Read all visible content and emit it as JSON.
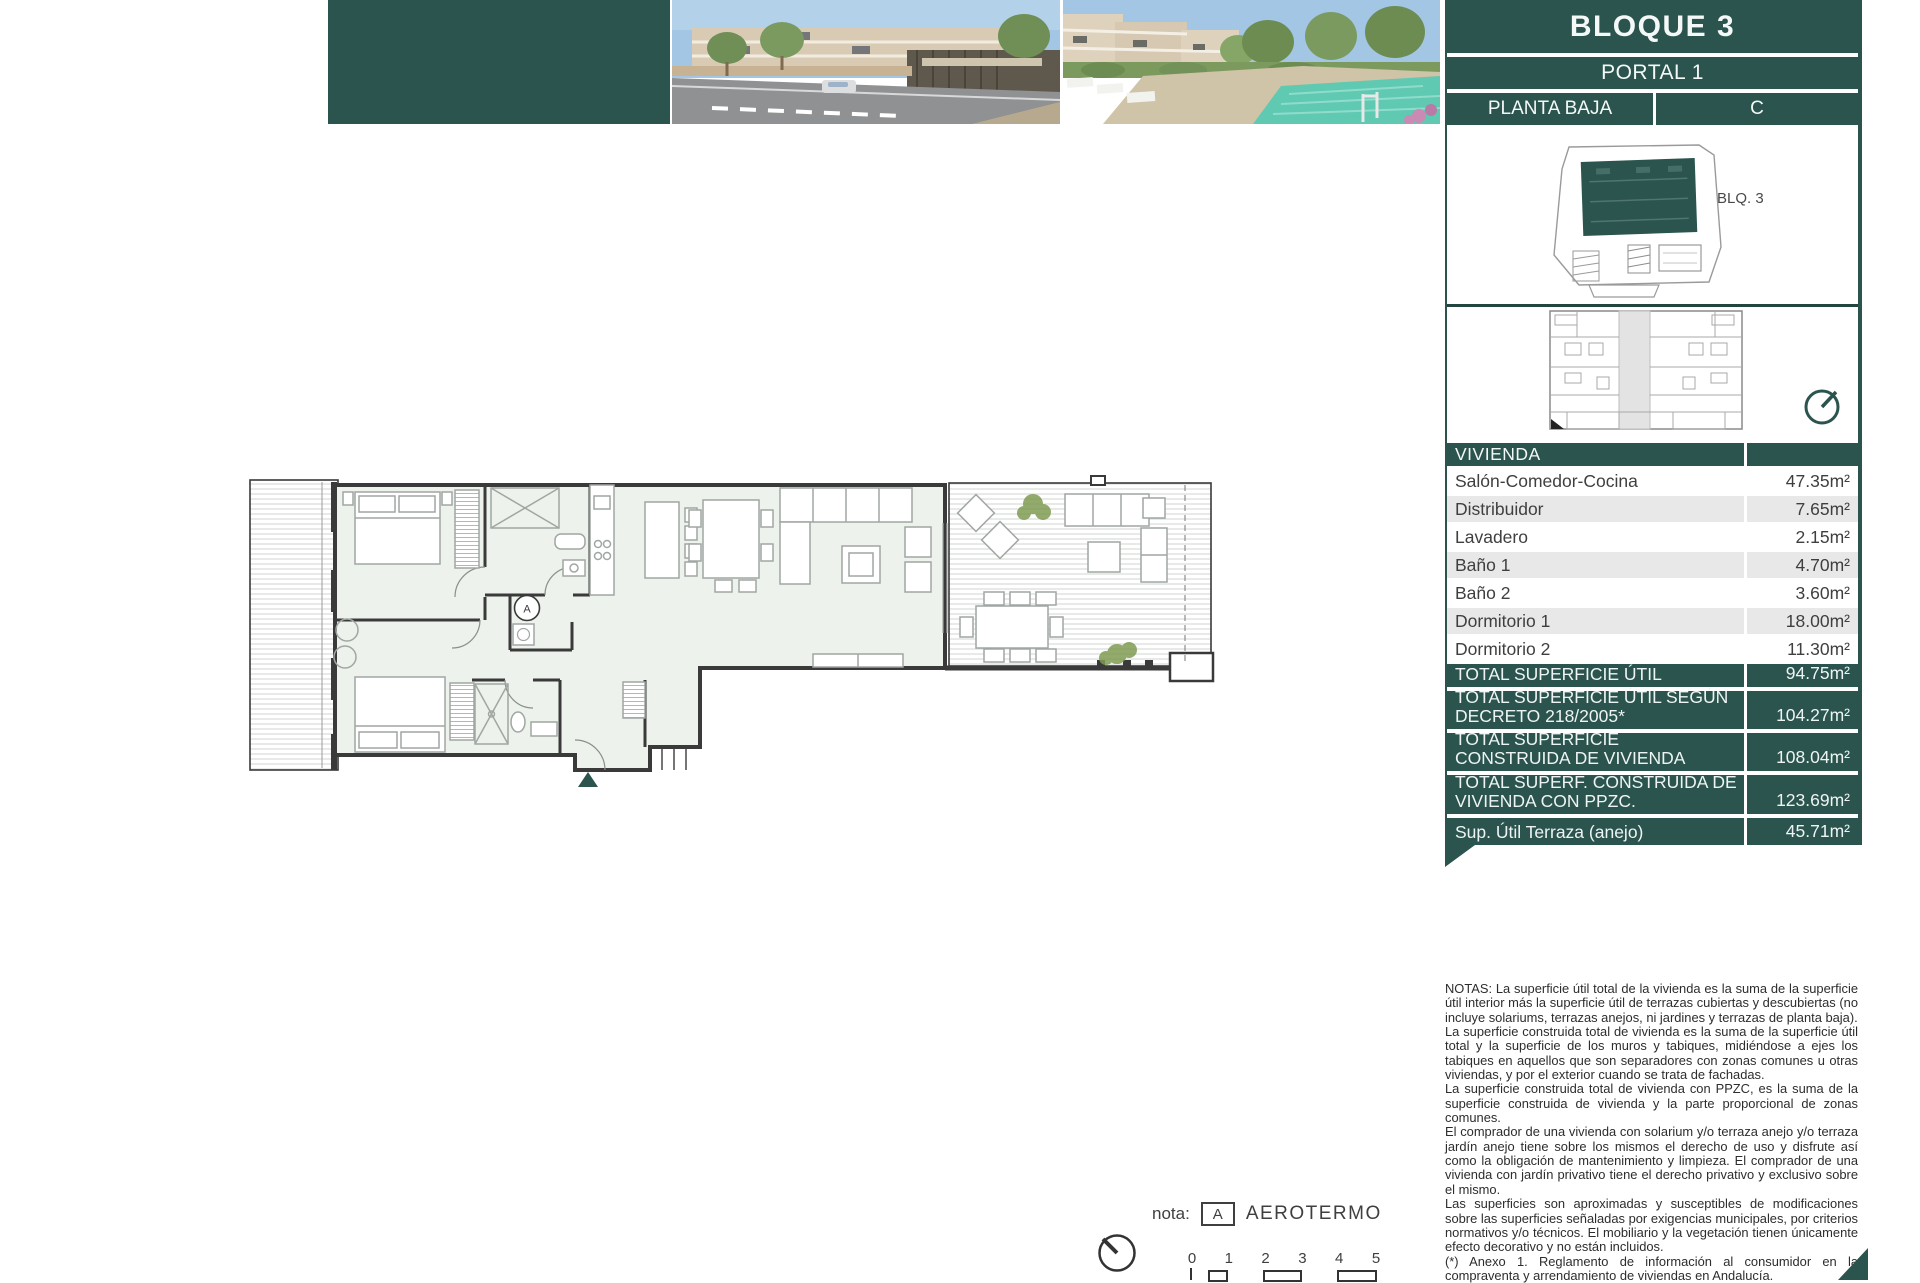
{
  "header": {
    "block_title": "BLOQUE 3",
    "portal": "PORTAL 1",
    "floor": "PLANTA BAJA",
    "unit_letter": "C"
  },
  "site_plan": {
    "label": "BLQ. 3"
  },
  "plan": {
    "marker_letter": "A"
  },
  "table": {
    "header": "VIVIENDA",
    "rows": [
      {
        "label": "Salón-Comedor-Cocina",
        "value": "47.35m²"
      },
      {
        "label": "Distribuidor",
        "value": "7.65m²"
      },
      {
        "label": "Lavadero",
        "value": "2.15m²"
      },
      {
        "label": "Baño 1",
        "value": "4.70m²"
      },
      {
        "label": "Baño 2",
        "value": "3.60m²"
      },
      {
        "label": "Dormitorio 1",
        "value": "18.00m²"
      },
      {
        "label": "Dormitorio 2",
        "value": "11.30m²"
      }
    ],
    "totals": [
      {
        "label": "TOTAL SUPERFICIE ÚTIL",
        "value": "94.75m²"
      },
      {
        "label": "TOTAL SUPERFICIE ÚTIL SEGÚN\nDECRETO 218/2005*",
        "value": "104.27m²"
      },
      {
        "label": "TOTAL SUPERFICIE\nCONSTRUIDA DE VIVIENDA",
        "value": "108.04m²"
      },
      {
        "label": "TOTAL SUPERF. CONSTRUIDA DE\nVIVIENDA CON PPZC.",
        "value": "123.69m²"
      },
      {
        "label": "Sup. Útil Terraza (anejo)",
        "value": "45.71m²"
      }
    ]
  },
  "notes": {
    "paragraphs": [
      "NOTAS:      La superficie útil total de la vivienda es la suma de la superficie útil interior más la superficie útil de terrazas cubiertas y descubiertas (no incluye solariums, terrazas anejos, ni jardines y terrazas de planta baja).",
      "La superficie construida total de vivienda es la suma de la superficie útil total y la superficie de los muros y tabiques, midiéndose a ejes los tabiques en aquellos que son separadores con zonas comunes u otras viviendas, y por el exterior cuando se trata de fachadas.",
      "La superficie construida total de vivienda con PPZC, es la suma de la superficie construida de vivienda y la parte proporcional de zonas comunes.",
      "El comprador de una vivienda con solarium y/o terraza anejo y/o terraza jardín anejo tiene sobre los mismos el derecho de uso y disfrute así como la obligación de mantenimiento y limpieza. El comprador de una vivienda con jardín privativo tiene el derecho privativo y exclusivo sobre el mismo.",
      "Las superficies son aproximadas y susceptibles de modificaciones sobre las superficies señaladas por exigencias municipales, por criterios normativos y/o técnicos. El mobiliario y la vegetación tienen únicamente efecto decorativo y no están incluidos.",
      " (*) Anexo 1. Reglamento de información al consumidor en la compraventa y arrendamiento de viviendas en Andalucía."
    ]
  },
  "footer": {
    "nota_label": "nota:",
    "marker_letter": "A",
    "marker_text": "AEROTERMO",
    "scale_labels": [
      "0",
      "1",
      "2",
      "3",
      "4",
      "5"
    ]
  },
  "colors": {
    "brand_teal": "#2b544e",
    "row_gray": "#e8e8e8",
    "floor_fill": "#edf2ec",
    "pool": "#5fc9b2"
  }
}
